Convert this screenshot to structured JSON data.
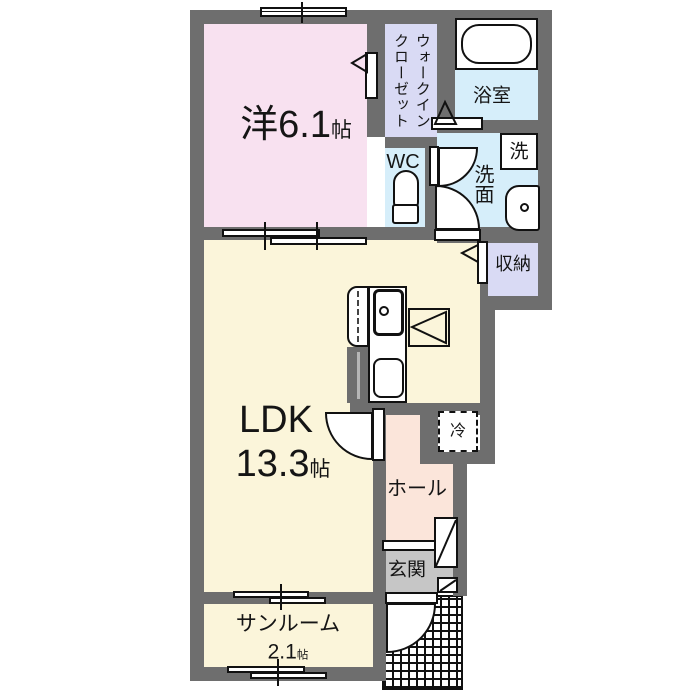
{
  "floor_plan": {
    "western_room": {
      "label_main": "洋6.1",
      "label_unit": "帖"
    },
    "walk_in_closet": {
      "line1": "ウォークイン",
      "line2": "クローゼット"
    },
    "wc": {
      "label": "WC"
    },
    "bathroom": {
      "label": "浴室"
    },
    "washroom": {
      "label": "洗面"
    },
    "washing_machine": {
      "label": "洗"
    },
    "storage": {
      "label": "収納"
    },
    "ldk": {
      "label": "LDK",
      "size_main": "13.3",
      "size_unit": "帖"
    },
    "refrigerator": {
      "label": "冷"
    },
    "hall": {
      "label": "ホール"
    },
    "entrance": {
      "label": "玄関"
    },
    "sunroom": {
      "label": "サンルーム",
      "size_main": "2.1",
      "size_unit": "帖"
    },
    "colors": {
      "wall": "#6e6e6e",
      "western_room": "#f8e1f0",
      "closet": "#d9daf4",
      "wet_area": "#d6eefa",
      "ldk": "#fbf5da",
      "hall": "#fbe5da",
      "entrance_floor": "#c6c6c6",
      "porch_grid": "#111111"
    }
  }
}
